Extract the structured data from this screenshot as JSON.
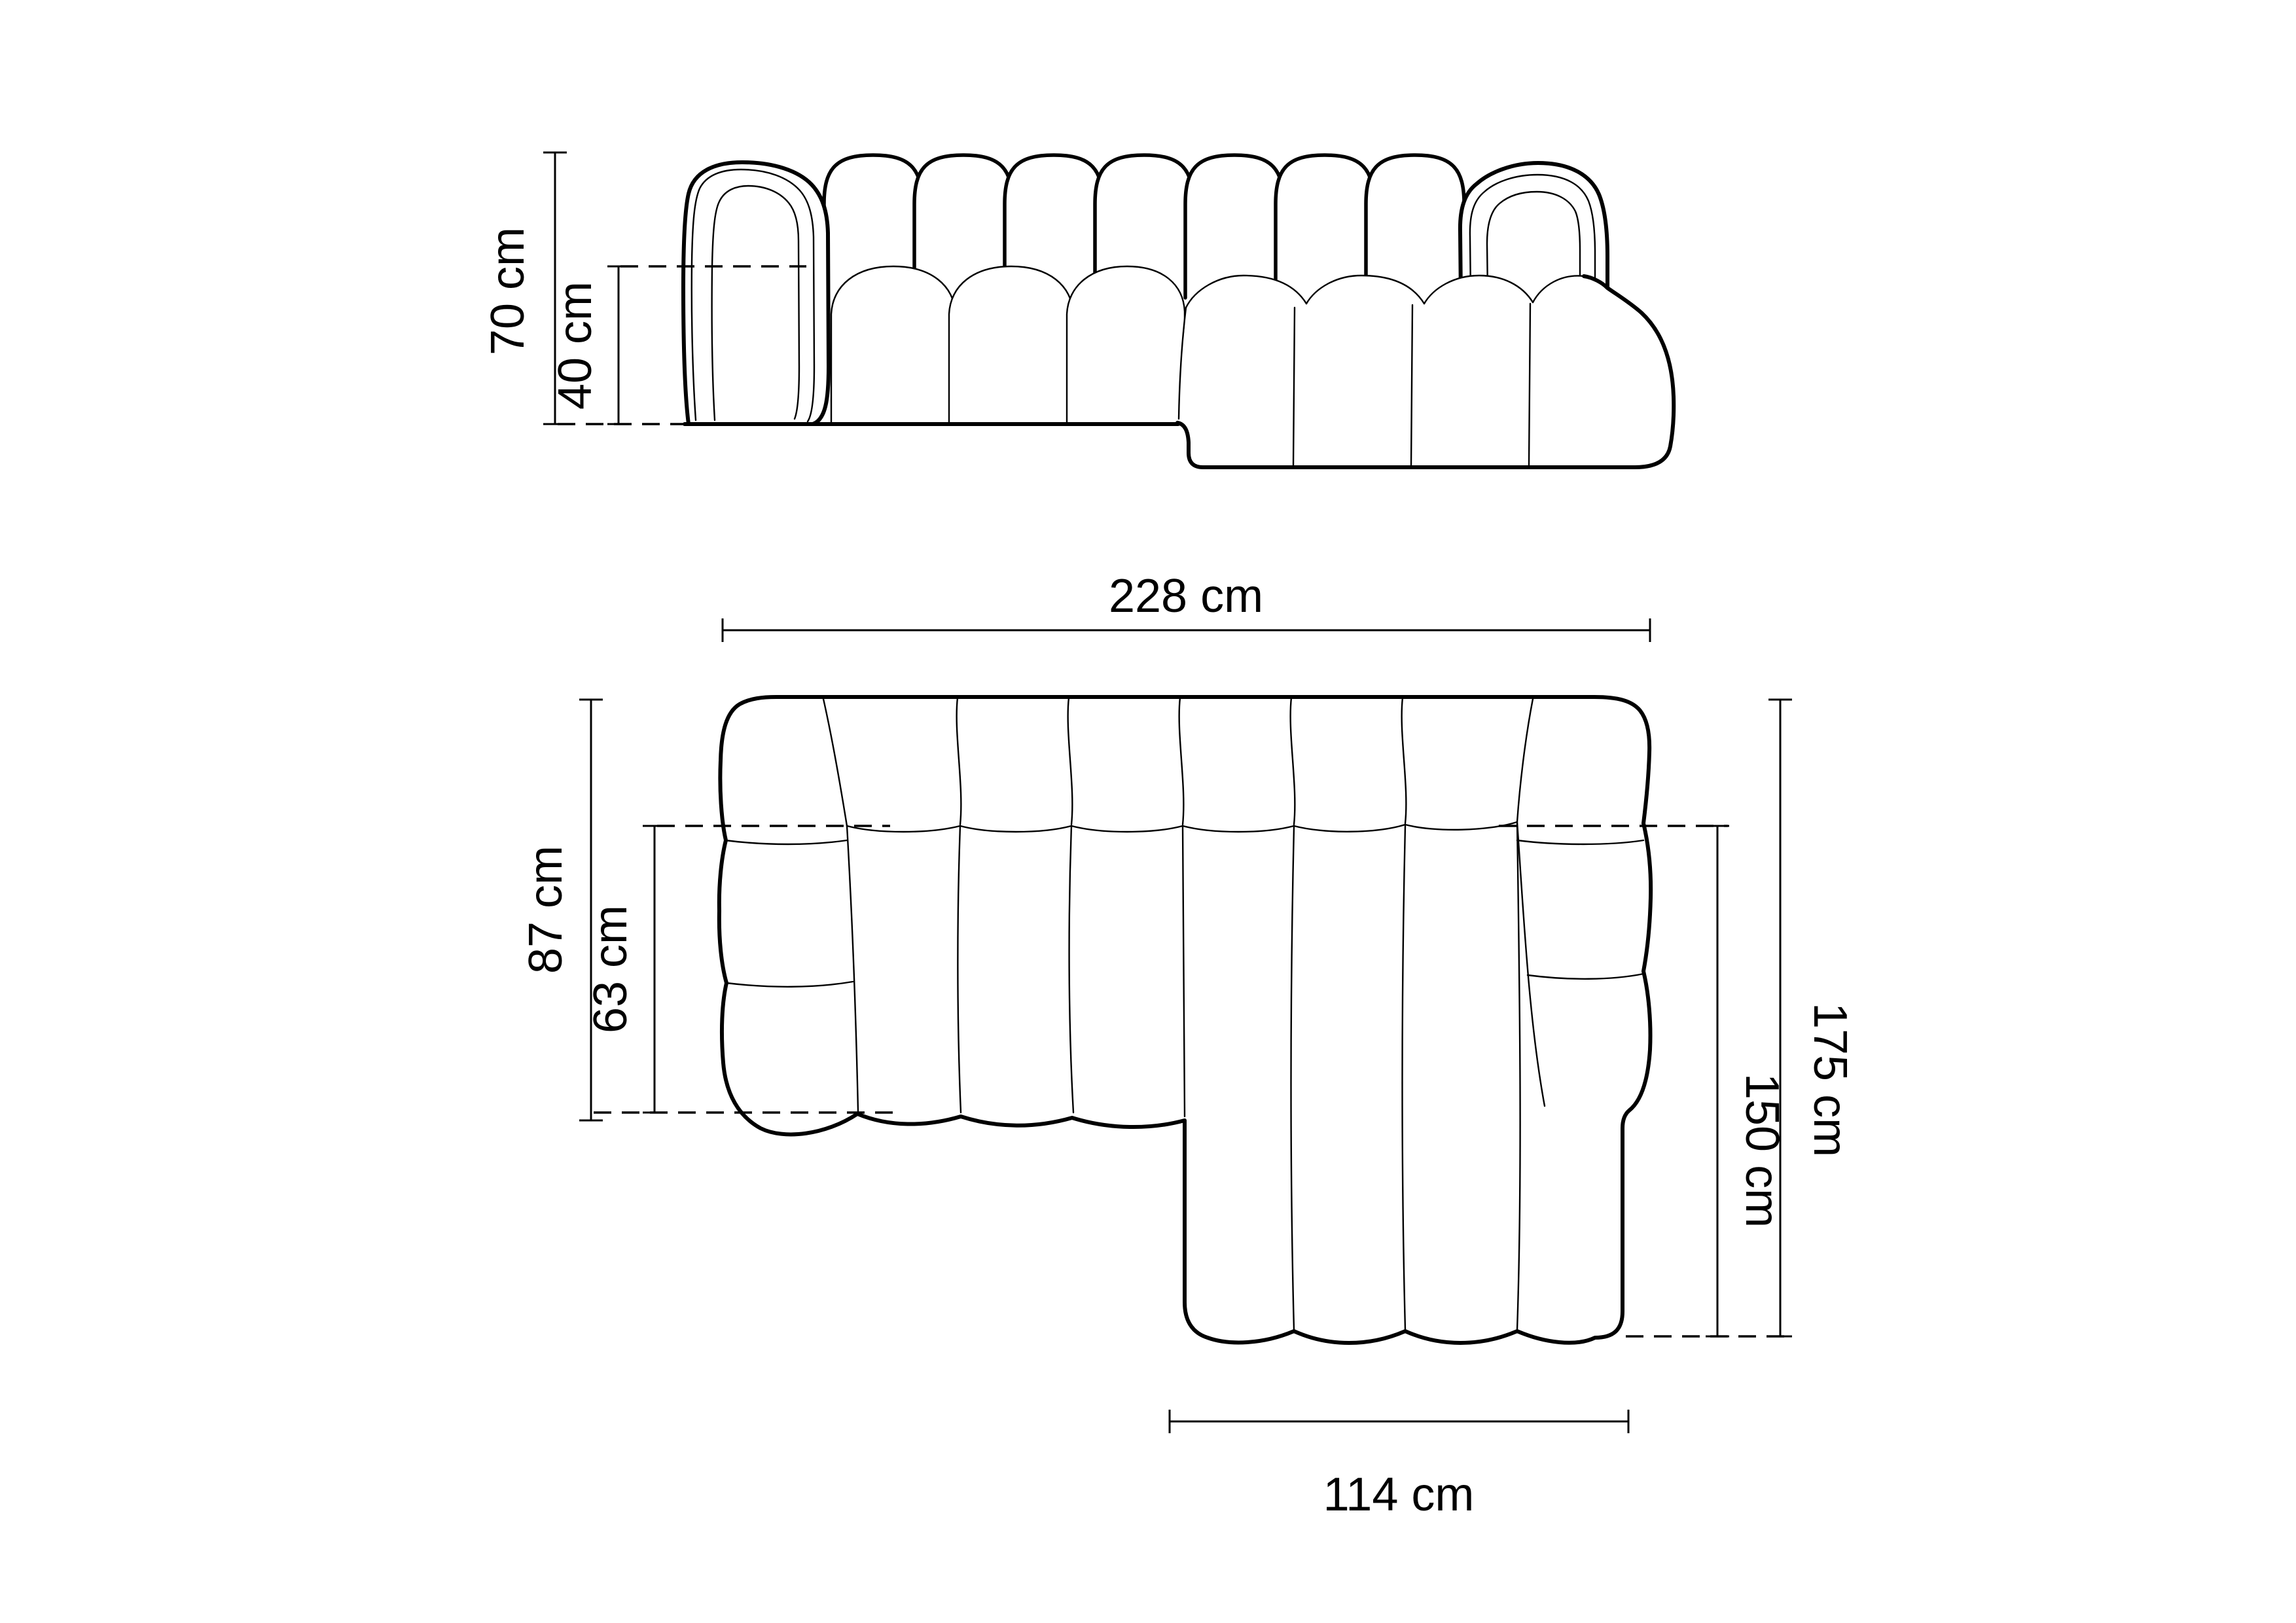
{
  "diagram": {
    "front_view": {
      "total_height": "70 cm",
      "seat_height": "40 cm"
    },
    "plan_view": {
      "total_width": "228 cm",
      "total_depth": "87 cm",
      "seat_depth": "63 cm",
      "side_total_depth": "175 cm",
      "chaise_depth": "150 cm",
      "chaise_width": "114 cm"
    },
    "style": {
      "background": "#ffffff",
      "line_color": "#000000"
    }
  }
}
